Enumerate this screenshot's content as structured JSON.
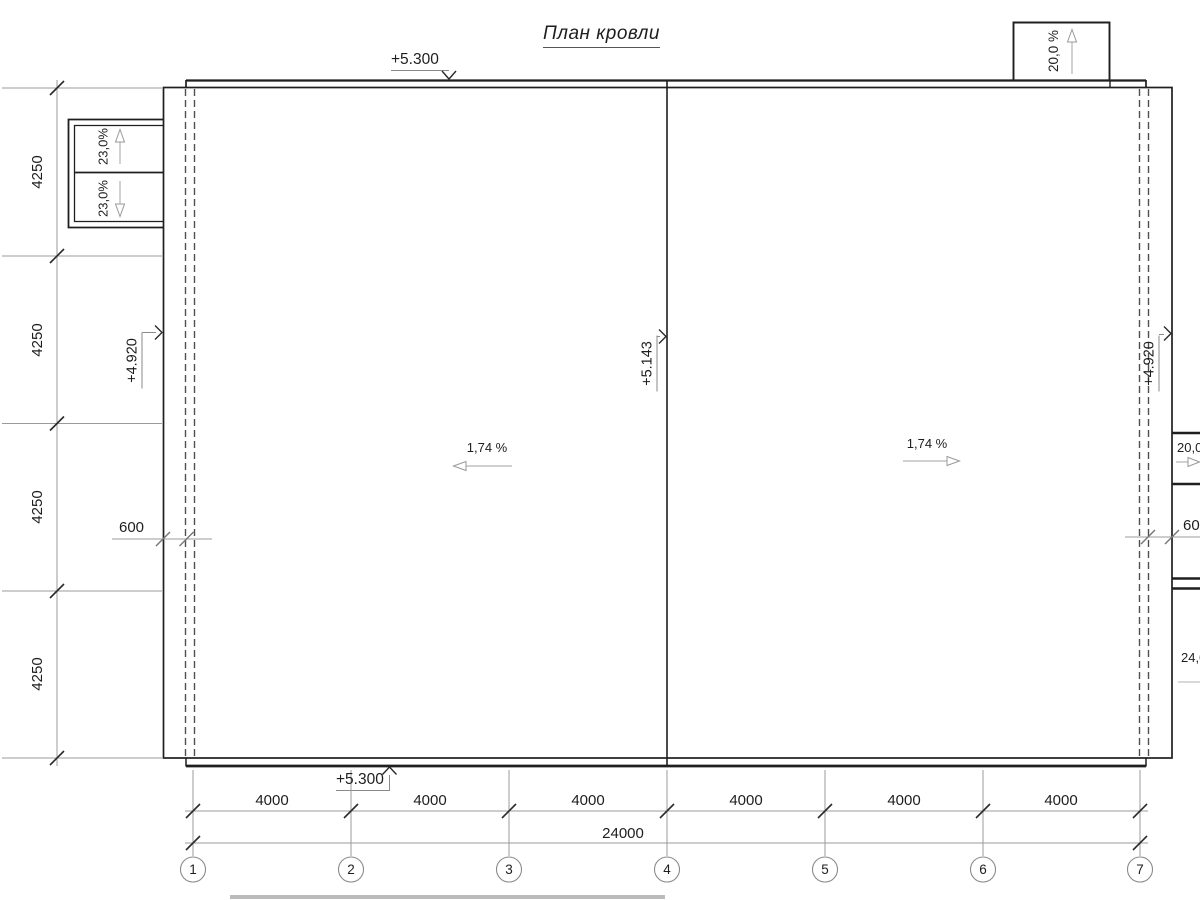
{
  "title": "План кровли",
  "elevations": {
    "roof_top_edge": "+5.300",
    "roof_bottom_edge": "+5.300",
    "left_eave": "+4.920",
    "right_eave": "+4.920",
    "ridge_valley": "+5.143"
  },
  "slopes": {
    "main_left": "1,74 %",
    "main_right": "1,74 %",
    "canopy_top": "20,0 %",
    "entrance_upper": "23,0%",
    "entrance_lower": "23,0%",
    "right_upper": "20,0 %",
    "right_lower": "24,0 %"
  },
  "dims": {
    "left_bays": [
      "4250",
      "4250",
      "4250",
      "4250"
    ],
    "bottom_bays": [
      "4000",
      "4000",
      "4000",
      "4000",
      "4000",
      "4000"
    ],
    "total": "24000",
    "parapet_left": "600",
    "parapet_right": "600"
  },
  "grid": [
    "1",
    "2",
    "3",
    "4",
    "5",
    "6",
    "7"
  ]
}
